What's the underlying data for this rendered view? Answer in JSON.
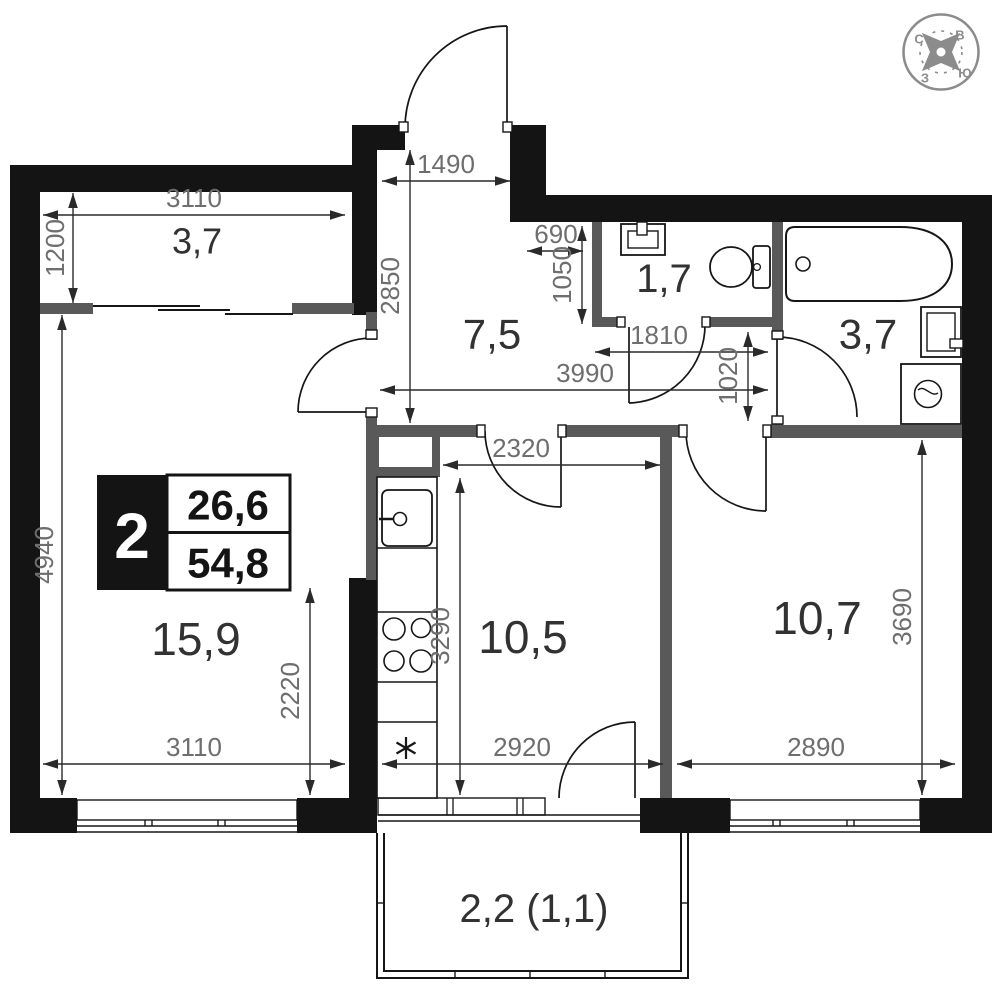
{
  "badge": {
    "rooms_count": "2",
    "living_area": "26,6",
    "total_area": "54,8"
  },
  "compass": {
    "north": "С",
    "east": "В",
    "west": "З",
    "south": "Ю"
  },
  "rooms": [
    {
      "name": "loggia-top",
      "area": "3,7"
    },
    {
      "name": "hallway",
      "area": "7,5"
    },
    {
      "name": "wc",
      "area": "1,7"
    },
    {
      "name": "bathroom",
      "area": "3,7"
    },
    {
      "name": "living-room",
      "area": "15,9"
    },
    {
      "name": "kitchen",
      "area": "10,5"
    },
    {
      "name": "bedroom",
      "area": "10,7"
    },
    {
      "name": "balcony",
      "area": "2,2 (1,1)"
    }
  ],
  "dimensions_mm": [
    {
      "value": "3110",
      "orientation": "horizontal",
      "location": "loggia-top-width"
    },
    {
      "value": "1200",
      "orientation": "vertical",
      "location": "loggia-depth"
    },
    {
      "value": "1490",
      "orientation": "horizontal",
      "location": "entry-width"
    },
    {
      "value": "2850",
      "orientation": "vertical",
      "location": "hallway-depth"
    },
    {
      "value": "690",
      "orientation": "horizontal",
      "location": "niche-width"
    },
    {
      "value": "1050",
      "orientation": "vertical",
      "location": "wc-depth"
    },
    {
      "value": "1810",
      "orientation": "horizontal",
      "location": "corridor-to-bath"
    },
    {
      "value": "3990",
      "orientation": "horizontal",
      "location": "hallway-full-width"
    },
    {
      "value": "1020",
      "orientation": "vertical",
      "location": "corridor-height"
    },
    {
      "value": "4940",
      "orientation": "vertical",
      "location": "living-room-height"
    },
    {
      "value": "2320",
      "orientation": "horizontal",
      "location": "kitchen-width"
    },
    {
      "value": "3290",
      "orientation": "vertical",
      "location": "kitchen-depth"
    },
    {
      "value": "2220",
      "orientation": "vertical",
      "location": "living-lower-height"
    },
    {
      "value": "3110",
      "orientation": "horizontal",
      "location": "living-room-width"
    },
    {
      "value": "2920",
      "orientation": "horizontal",
      "location": "balcony-opening-width"
    },
    {
      "value": "2890",
      "orientation": "horizontal",
      "location": "bedroom-width"
    },
    {
      "value": "3690",
      "orientation": "vertical",
      "location": "bedroom-height"
    }
  ],
  "colors": {
    "wall": "#141414",
    "partition": "#595959",
    "dim_text": "#6e6e6e",
    "compass": "#8c8c8c"
  }
}
